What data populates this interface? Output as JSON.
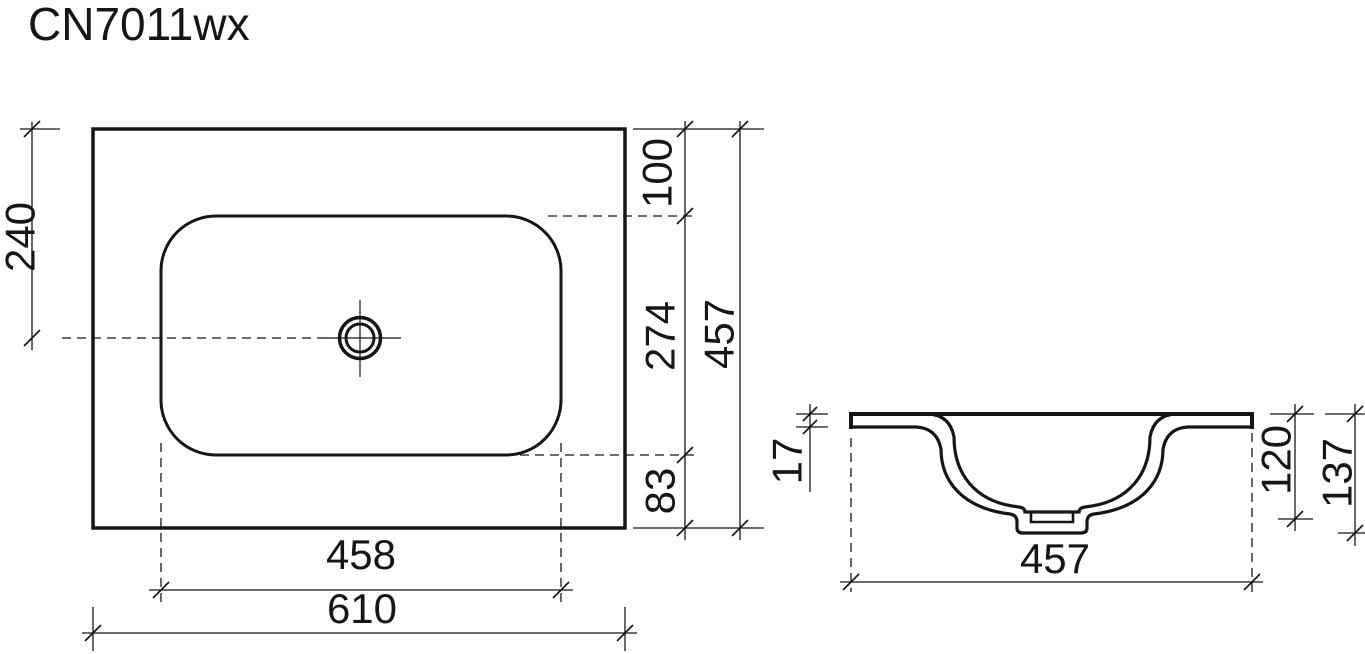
{
  "title": "CN7011wx",
  "colors": {
    "line": "#161616",
    "background": "#ffffff"
  },
  "top_view": {
    "dim_faucet_center_from_top": "240",
    "dim_top_edge_to_basin": "100",
    "dim_basin_length": "274",
    "dim_basin_to_bottom_edge": "83",
    "dim_overall_depth": "457",
    "dim_basin_width": "458",
    "dim_overall_width": "610"
  },
  "side_view": {
    "dim_rim_thickness": "17",
    "dim_bowl_depth": "120",
    "dim_overall_height": "137",
    "dim_overall_width": "457"
  }
}
